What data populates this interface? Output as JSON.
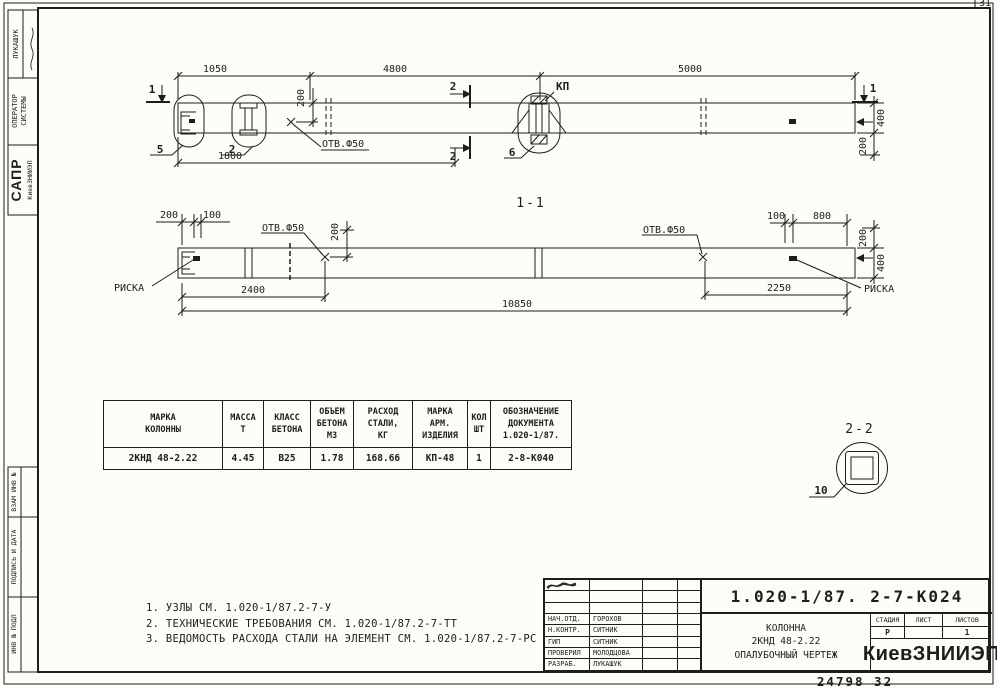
{
  "sheet": {
    "corner_mark": "31",
    "footer_number": "24798  32"
  },
  "sidebar": {
    "author": "ЛУКАШУК",
    "operator_line1": "ОПЕРАТОР",
    "operator_line2": "СИСТЕМЫ",
    "sapr": "САПР",
    "sapr_org": "КиевЗНИИЭП",
    "vzam": "ВЗАМ ИНВ №",
    "podpis": "ПОДПИСЬ И ДАТА",
    "inv": "ИНВ № ПОДЛ"
  },
  "top_view": {
    "dim_1050": "1050",
    "dim_4800": "4800",
    "dim_5000": "5000",
    "dim_1800": "1800",
    "dim_200_hole": "200",
    "dim_400": "400",
    "dim_200_end": "200",
    "hole_label": "ОТВ.Ф50",
    "kp_label": "КП",
    "callout_5": "5",
    "callout_2": "2",
    "callout_6": "6",
    "section_1": "1",
    "section_2": "2"
  },
  "view_1_1": {
    "title": "1-1",
    "dim_200_left": "200",
    "dim_100_left": "100",
    "hole_label": "ОТВ.Ф50",
    "dim_200_hole": "200",
    "dim_100_right": "100",
    "dim_800": "800",
    "dim_200_end": "200",
    "dim_400": "400",
    "dim_2400": "2400",
    "dim_2250": "2250",
    "dim_10850": "10850",
    "riska": "РИСКА"
  },
  "view_2_2": {
    "title": "2-2",
    "callout_10": "10"
  },
  "spec_table": {
    "headers": [
      "МАРКА\nКОЛОННЫ",
      "МАССА\nТ",
      "КЛАСС\nБЕТОНА",
      "ОБЪЕМ\nБЕТОНА\nМ3",
      "РАСХОД\nСТАЛИ,\nКГ",
      "МАРКА\nАРМ.\nИЗДЕЛИЯ",
      "КОЛ\nШТ",
      "ОБОЗНАЧЕНИЕ\nДОКУМЕНТА\n1.020-1/87."
    ],
    "row": [
      "2КНД 48-2.22",
      "4.45",
      "В25",
      "1.78",
      "168.66",
      "КП-48",
      "1",
      "2-8-К040"
    ]
  },
  "notes": [
    "1. УЗЛЫ СМ. 1.020-1/87.2-7-У",
    "2. ТЕХНИЧЕСКИЕ ТРЕБОВАНИЯ СМ. 1.020-1/87.2-7-ТТ",
    "3. ВЕДОМОСТЬ РАСХОДА СТАЛИ НА ЭЛЕМЕНТ СМ. 1.020-1/87.2-7-РС"
  ],
  "title_block": {
    "doc_number": "1.020-1/87. 2-7-К024",
    "product_title": "КОЛОННА\n2КНД 48-2.22\nОПАЛУБОЧНЫЙ ЧЕРТЕЖ",
    "org": "КиевЗНИИЭП",
    "stage_label": "СТАДИЯ",
    "sheet_label": "ЛИСТ",
    "sheets_label": "ЛИСТОВ",
    "stage_value": "Р",
    "sheet_value": "",
    "sheets_value": "1",
    "roles": [
      {
        "role": "НАЧ.ОТД.",
        "name": "ГОРОХОВ"
      },
      {
        "role": "Н.КОНТР.",
        "name": "СИТНИК"
      },
      {
        "role": "ГИП",
        "name": "СИТНИК"
      },
      {
        "role": "ПРОВЕРИЛ",
        "name": "МОЛОДЦОВА"
      },
      {
        "role": "РАЗРАБ.",
        "name": "ЛУКАШУК"
      }
    ]
  }
}
